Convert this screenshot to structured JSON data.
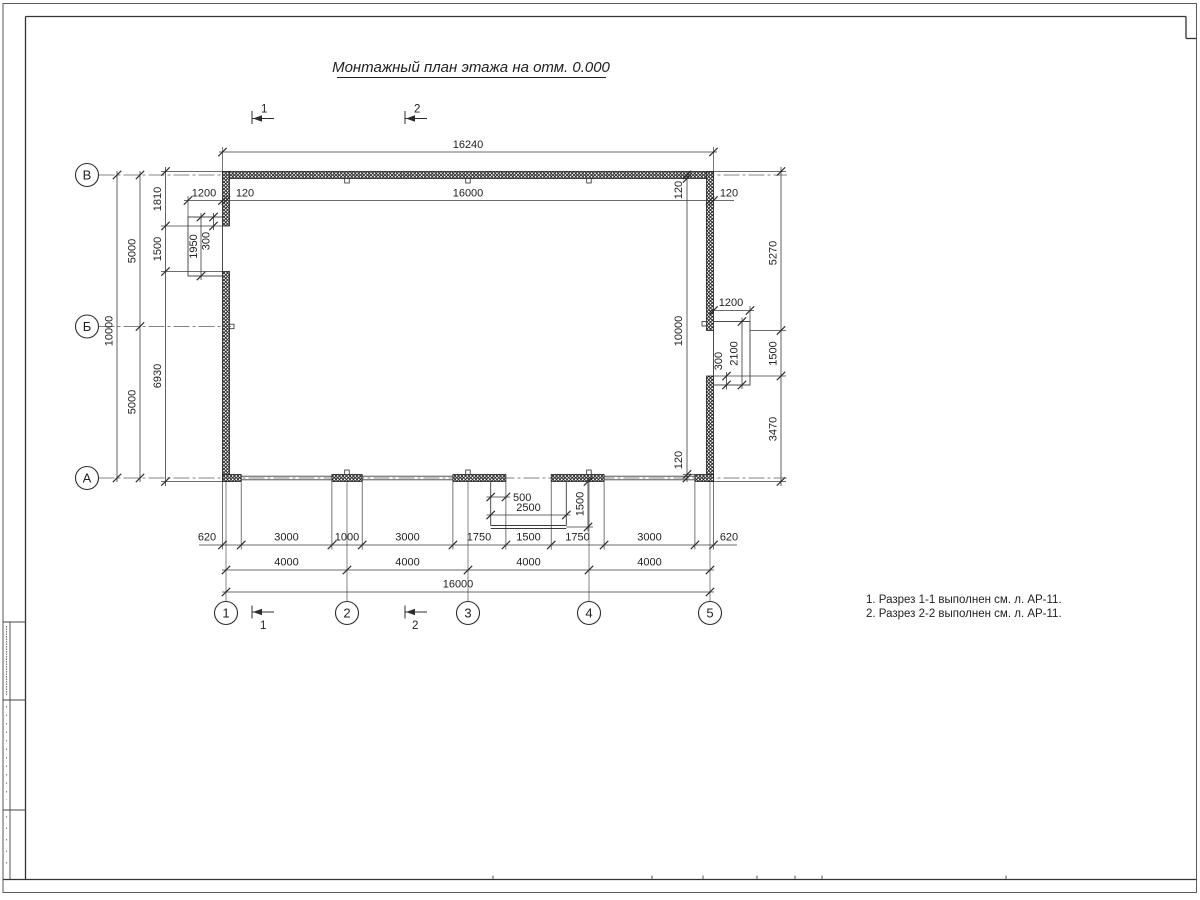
{
  "title": "Монтажный план этажа на отм. 0.000",
  "axes": {
    "rows": [
      "В",
      "Б",
      "А"
    ],
    "cols": [
      "1",
      "2",
      "3",
      "4",
      "5"
    ]
  },
  "sections": {
    "top": [
      "1",
      "2"
    ],
    "bottom": [
      "1",
      "2"
    ]
  },
  "dims": {
    "top_overall": "16240",
    "inner_width": "16000",
    "d120": "120",
    "left_outer": "10000",
    "right_height": "10000",
    "left_half": [
      "5000",
      "5000"
    ],
    "left_chain": [
      "1810",
      "1500",
      "6930"
    ],
    "left_porch": {
      "width": "1200",
      "length": "1950",
      "offset": "300"
    },
    "right_chain": [
      "5270",
      "1500",
      "3470"
    ],
    "right_porch": {
      "width": "1200",
      "length": "2100",
      "offset": "300"
    },
    "bottom_porch": {
      "offset": "500",
      "width": "2500",
      "depth": "1500"
    },
    "bottom_chain": [
      "620",
      "3000",
      "1000",
      "3000",
      "1750",
      "1500",
      "1750",
      "3000",
      "620"
    ],
    "bottom_spans": [
      "4000",
      "4000",
      "4000",
      "4000"
    ],
    "bottom_overall": "16000"
  },
  "notes": [
    "1. Разрез 1-1 выполнен см. л. АР-11.",
    "2. Разрез 2-2 выполнен см. л. АР-11."
  ],
  "colors": {
    "line": "#3a3a3a",
    "wall": "#1d1d1d",
    "bg": "#ffffff"
  }
}
